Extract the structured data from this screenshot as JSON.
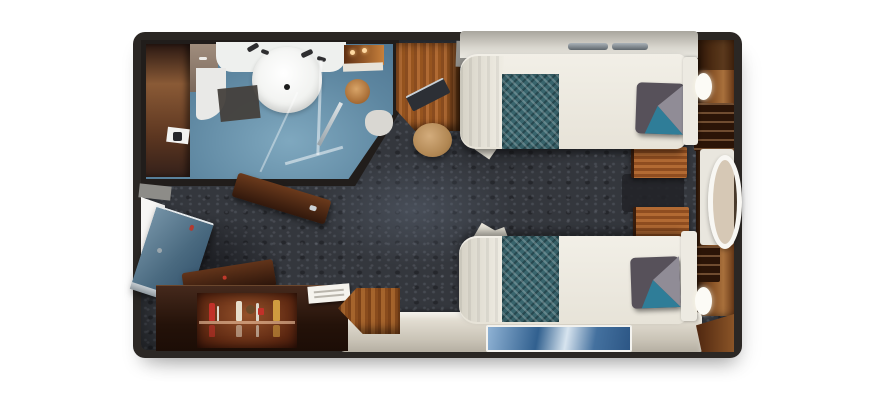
{
  "scene": {
    "description": "Top-down 3D rendered floor plan of a cruise ship stateroom with bathroom, two twin beds, desk, wardrobe and entry door",
    "background_color": "#ffffff",
    "wall_frame_color": "#2b2724",
    "carpet_color": "#34373d"
  },
  "rooms": {
    "bathroom": {
      "label": "Bathroom with washbasin, vanity counter, shower enclosure and wood-panel door",
      "floor_color": "#5d86a0",
      "sink_color": "#ffffff",
      "wood_door_color": "#8a5a36"
    },
    "cabin": {
      "label": "Main cabin area with dark mottled carpet",
      "carpet_color": "#34373d"
    }
  },
  "furniture": {
    "bed_1": {
      "label": "Twin bed (upper) with white duvet, teal runner and accent pillow",
      "duvet_color": "#efece3",
      "runner_color": "#39656d",
      "accent_pillow_colors": [
        "#57515a",
        "#908c96",
        "#2f7d98"
      ]
    },
    "bed_2": {
      "label": "Twin bed (lower) with white duvet, teal runner and accent pillow",
      "duvet_color": "#efece3",
      "runner_color": "#39656d",
      "accent_pillow_colors": [
        "#57515a",
        "#908c96",
        "#2f7d98"
      ]
    },
    "nightstands": {
      "label": "Two wooden nightstands between the beds",
      "count": 2,
      "wood_color": "#a35e2d"
    },
    "headboards": {
      "label": "White upholstered headboards on window wall",
      "color": "#edeae2"
    },
    "vanity_desk": {
      "label": "Wood vanity desk with dark seat and round tan stool",
      "wood_color": "#a5642c",
      "stool_color": "#c2a06e"
    },
    "wardrobe_doors": {
      "label": "Two open dark-wood wardrobe doors",
      "color": "#4a2a14"
    },
    "minibar_console": {
      "label": "Dark wood console with backlit minibar shelf, bottles, glasses and notepad",
      "cabinet_color": "#2a1710",
      "glow_color": "#94512a",
      "bottle_colors": [
        "#c13129",
        "#e7decb",
        "#6b4a28",
        "#cf9b3f"
      ]
    },
    "corner_table": {
      "label": "Wood corner table by the bench",
      "color": "#a5642c"
    },
    "bench_sofa": {
      "label": "Cream bench sofa along bottom wall",
      "color": "#d8d2c6"
    },
    "artwork": {
      "label": "Blue seascape art panel on bench wall",
      "colors": [
        "#31608f",
        "#d7e4ef"
      ]
    },
    "entry_door": {
      "label": "Open steel-blue entry door with white doorway",
      "color": "#4a6a80"
    },
    "right_wall": {
      "label": "Wood-paneled window wall with dressers, porthole ring and two oval wall lamps",
      "wood_color": "#8a5427",
      "lamp_color": "#fcfbf6",
      "lamp_count": 2
    },
    "overhead_shelf": {
      "label": "Shelf band with metal rails above upper bed",
      "color": "#d8d5cd"
    }
  }
}
